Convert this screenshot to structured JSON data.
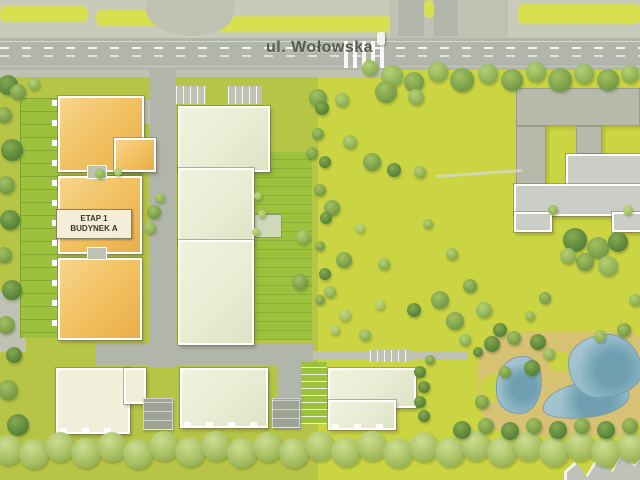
{
  "plan": {
    "street_label": "ul. Wołowska",
    "stage_label_line1": "ETAP 1",
    "stage_label_line2": "BUDYNEK A"
  },
  "colors": {
    "grass_park": "#cbd442",
    "grass_site": "#b7c546",
    "grass_bright": "#9cc13d",
    "grass_verge": "#d9e050",
    "road": "#b2b5a9",
    "sidewalk": "#c8cbb9",
    "sidewalk_dark": "#bfc2b2",
    "building_stage1": "#f2c364",
    "building_future": "#e7ecd2",
    "building_cream": "#f0efda",
    "building_existing": "#b7baab",
    "building_existing_light": "#cbcec6",
    "structure_gray": "#9fa396",
    "water": "#8fb7c6",
    "water_deep": "#6f9fb0",
    "sand": "#d7c173",
    "label_bg": "#f4eed8",
    "label_text": "#3a352a",
    "street_text": "#575a4e",
    "marking_white": "#ffffff"
  }
}
